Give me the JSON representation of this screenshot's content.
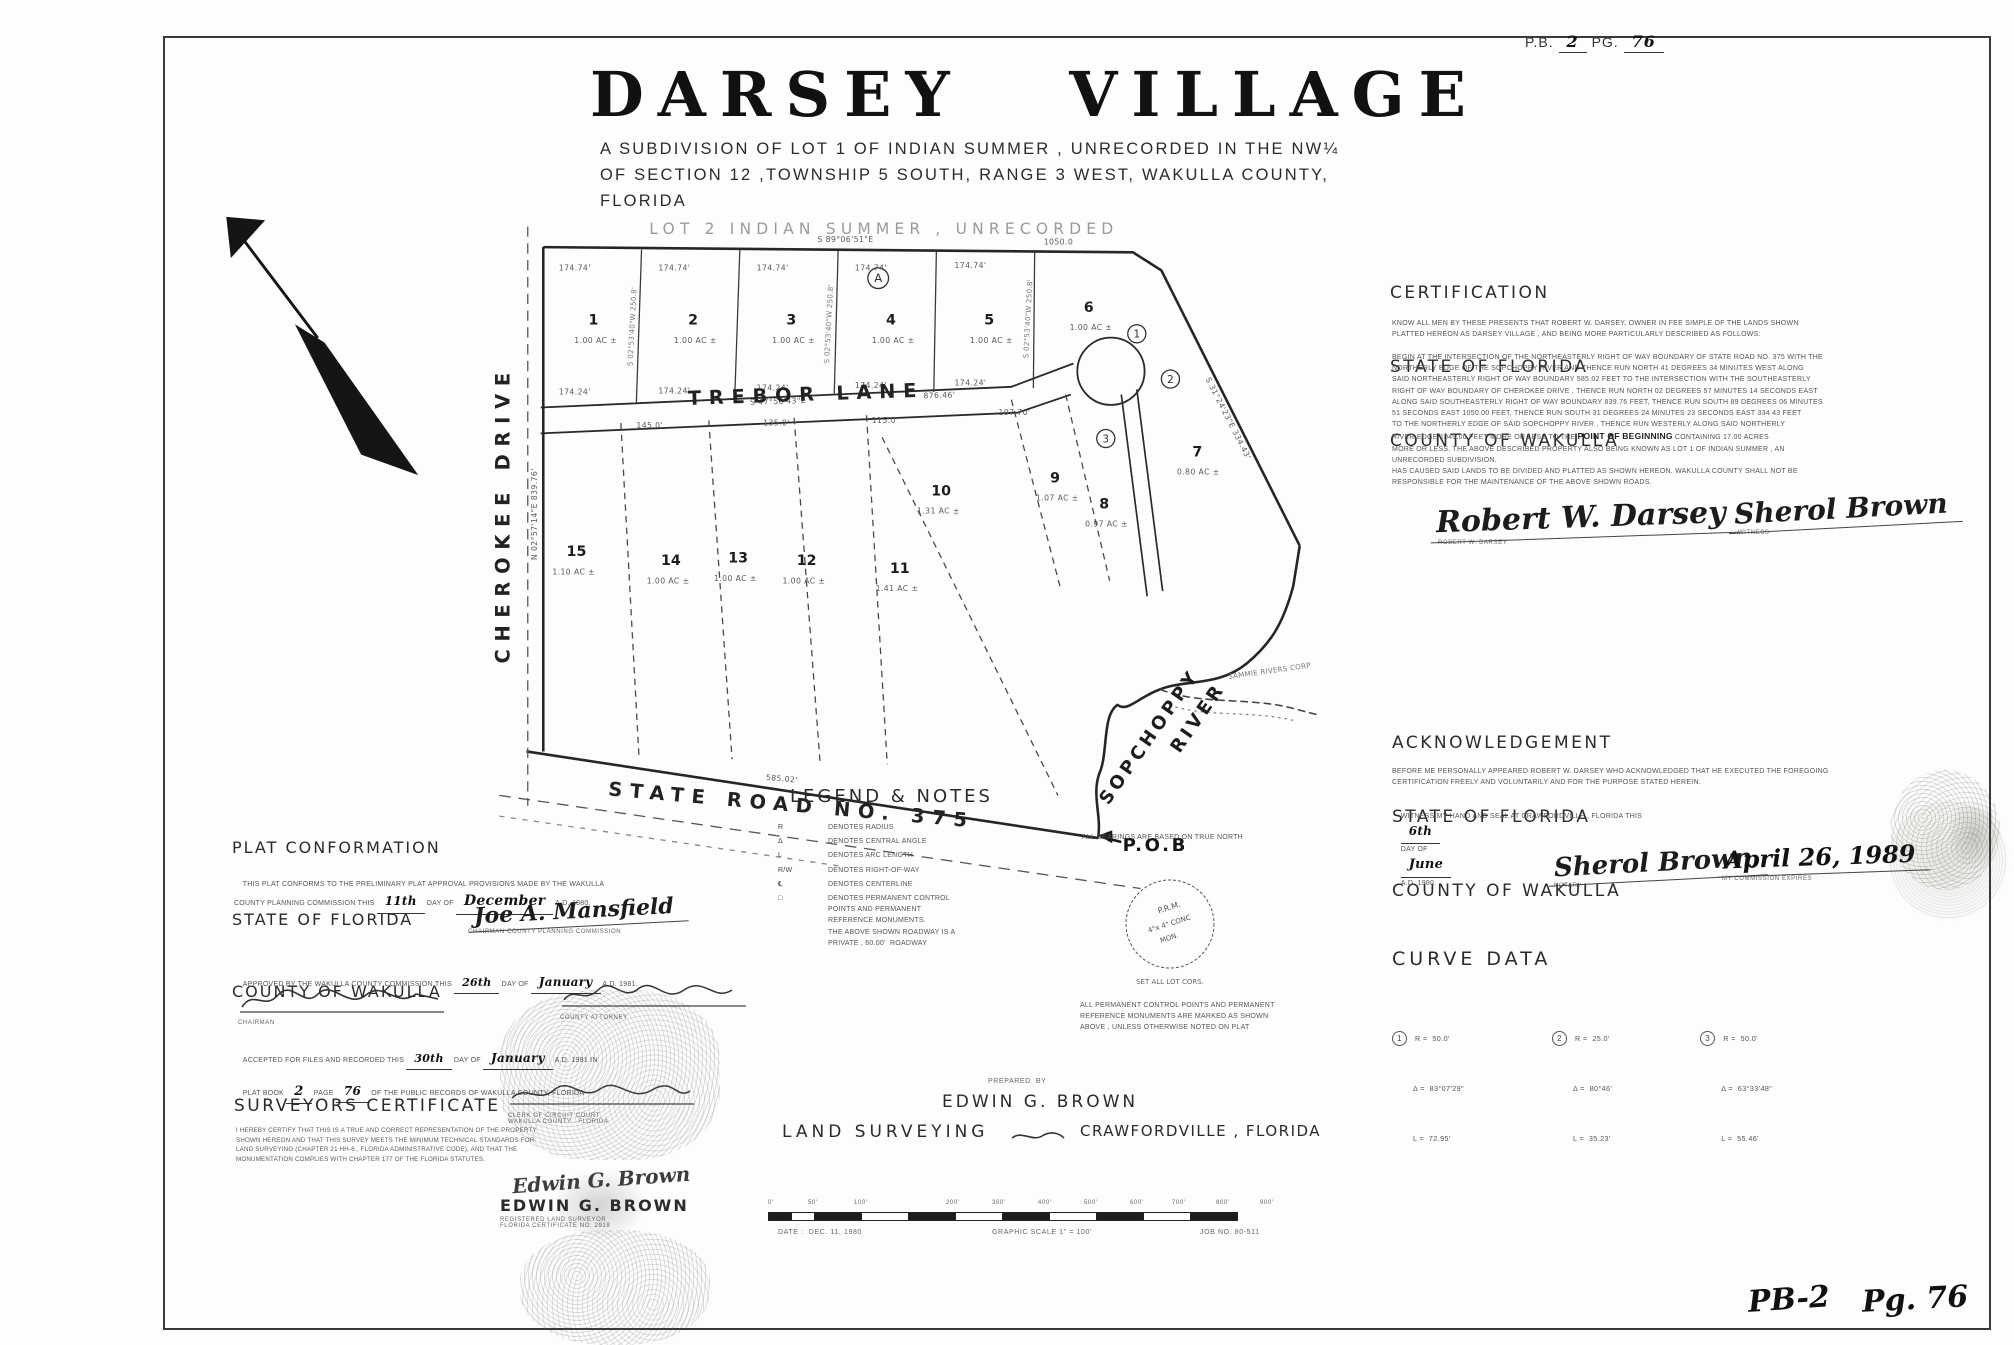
{
  "page": {
    "pb_label": "P.B.",
    "pb_value": "2",
    "pg_label": "PG.",
    "pg_value": "76",
    "corner_book": "PB-2",
    "corner_page": "Pg. 76"
  },
  "title": {
    "main": "DARSEY VILLAGE",
    "sub1": "A SUBDIVISION OF LOT 1 OF INDIAN SUMMER , UNRECORDED IN THE NW¼",
    "sub2": "OF SECTION 12 ,TOWNSHIP 5 SOUTH, RANGE 3 WEST, WAKULLA COUNTY,",
    "sub3": "FLORIDA"
  },
  "plat": {
    "faint_label": "LOT 2  INDIAN  SUMMER , UNRECORDED",
    "bearing_top": "S 89°06'51\"E",
    "dist_top": "1050.0",
    "dim_top": "174.74'",
    "dim_mid": "174.24'",
    "bearing_side": "S 02°53'40\"W  250.8'",
    "lane_bearing": "S 47°56'43\"E",
    "lane_dist": "876.46'",
    "bearing_ne": "S 31°24'23\"E  334.43'",
    "bearing_left": "N 02°57'14\"E  839.76'",
    "bearing_road": "585.02'",
    "street_trebor": "TREBOR      LANE",
    "street_cherokee": "CHEROKEE    DRIVE",
    "street_road": "STATE  ROAD  NO. 375",
    "river1": "SOPCHOPPY",
    "river2": "RIVER",
    "pob": "P.O.B",
    "corp": "SAMMIE RIVERS CORP",
    "block_mark": "A",
    "curve_marks": [
      "1",
      "2",
      "3"
    ],
    "lower_dims": [
      "145.0'",
      "135.0'",
      "115.0'",
      "107.70'"
    ],
    "lots": [
      {
        "num": "1",
        "ac": "1.00 AC ±"
      },
      {
        "num": "2",
        "ac": "1.00 AC ±"
      },
      {
        "num": "3",
        "ac": "1.00 AC ±"
      },
      {
        "num": "4",
        "ac": "1.00 AC ±"
      },
      {
        "num": "5",
        "ac": "1.00 AC ±"
      },
      {
        "num": "6",
        "ac": "1.00 AC ±"
      },
      {
        "num": "7",
        "ac": "0.80 AC ±"
      },
      {
        "num": "8",
        "ac": "0.97 AC ±"
      },
      {
        "num": "9",
        "ac": "1.07 AC ±"
      },
      {
        "num": "10",
        "ac": "1.31 AC ±"
      },
      {
        "num": "11",
        "ac": "1.41 AC ±"
      },
      {
        "num": "12",
        "ac": "1.00 AC ±"
      },
      {
        "num": "13",
        "ac": "1.00 AC ±"
      },
      {
        "num": "14",
        "ac": "1.00 AC ±"
      },
      {
        "num": "15",
        "ac": "1.10 AC ±"
      }
    ]
  },
  "certification": {
    "h1": "CERTIFICATION",
    "h2": "STATE OF FLORIDA",
    "h3": "COUNTY OF WAKULLA",
    "intro": "KNOW ALL MEN BY THESE PRESENTS THAT ROBERT W. DARSEY, OWNER IN FEE SIMPLE OF THE LANDS SHOWN\nPLATTED HEREON AS DARSEY VILLAGE , AND BEING MORE PARTICULARLY DESCRIBED AS FOLLOWS:",
    "body_pre": "BEGIN AT THE INTERSECTION OF THE NORTHEASTERLY RIGHT OF WAY BOUNDARY OF STATE ROAD NO. 375 WITH THE\nNORTHERLY EDGE OF THE SOPCHOPPY RIVER AND THENCE RUN NORTH 41 DEGREES 34 MINUTES WEST ALONG\nSAID NORTHEASTERLY RIGHT OF WAY BOUNDARY 585.02 FEET TO THE INTERSECTION WITH THE SOUTHEASTERLY\nRIGHT OF WAY BOUNDARY OF CHEROKEE DRIVE , THENCE RUN NORTH 02 DEGREES 57 MINUTES 14 SECONDS EAST\nALONG SAID SOUTHEASTERLY RIGHT OF WAY BOUNDARY 839.76 FEET, THENCE RUN SOUTH 89 DEGREES 06 MINUTES\n51 SECONDS EAST 1050.00 FEET, THENCE RUN SOUTH 31 DEGREES 24 MINUTES 23 SECONDS EAST 334.43 FEET\nTO THE NORTHERLY EDGE OF SAID SOPCHOPPY RIVER , THENCE RUN WESTERLY ALONG SAID NORTHERLY\nRIVER EDGE 1049.00 FEET MORE OR LESS TO THE ",
    "pob_bold": "POINT OF BEGINNING",
    "body_post": " CONTAINING 17.00 ACRES\nMORE OR LESS. THE ABOVE DESCRIBED PROPERTY ALSO BEING KNOWN AS LOT 1 OF INDIAN SUMMER , AN\nUNRECORDED SUBDIVISION.\nHAS CAUSED SAID LANDS TO BE DIVIDED AND PLATTED AS SHOWN HEREON. WAKULLA COUNTY SHALL NOT BE\nRESPONSIBLE FOR THE MAINTENANCE OF THE ABOVE SHOWN ROADS.",
    "sig1_script": "Robert W. Darsey",
    "sig1_label": "ROBERT W. DARSEY",
    "sig2_script": "Sherol Brown",
    "sig2_label": "WITNESS"
  },
  "acknowledgement": {
    "h1": "ACKNOWLEDGEMENT",
    "h2": "STATE OF FLORIDA",
    "h3": "COUNTY OF WAKULLA",
    "body": "BEFORE ME PERSONALLY APPEARED ROBERT W. DARSEY WHO ACKNOWLEDGED THAT HE EXECUTED THE FOREGOING\nCERTIFICATION FREELY AND VOLUNTARILY AND FOR THE PURPOSE STATED HEREIN.",
    "witness_pre": "WITNESS MY HAND AND SEAL AT CRAWFORDVILLE , FLORIDA THIS",
    "witness_day": "6th",
    "witness_mid": "DAY OF",
    "witness_month": "June",
    "witness_post": "A.D. 1980.",
    "notary_script": "Sherol Brown",
    "notary_label": "NOTARY",
    "expires_script": "April 26, 1989",
    "expires_label": "MY COMMISSION EXPIRES"
  },
  "curve_data": {
    "heading": "CURVE DATA",
    "curves": [
      {
        "n": "1",
        "r": "R =  50.0'",
        "d": "Δ =  83°07'29\"",
        "l": "L =  72.95'"
      },
      {
        "n": "2",
        "r": "R =  25.0'",
        "d": "Δ =  80°46'",
        "l": "L =  35.23'"
      },
      {
        "n": "3",
        "r": "R =  50.0'",
        "d": "Δ =  63°33'48\"",
        "l": "L =  55.46'"
      }
    ]
  },
  "conformation": {
    "h1": "PLAT CONFORMATION",
    "h2": "STATE OF FLORIDA",
    "h3": "COUNTY OF WAKULLA",
    "body_pre": "THIS PLAT CONFORMS TO THE PRELIMINARY PLAT APPROVAL PROVISIONS MADE BY THE WAKULLA\nCOUNTY PLANNING COMMISSION THIS ",
    "day": "11th",
    "mid": " DAY OF ",
    "month": "December",
    "post": " A.D. 1980.",
    "sig_chair_script": "Joe A. Mansfield",
    "sig_chair_label": "CHAIRMAN COUNTY PLANNING COMMISSION",
    "approved_pre": "APPROVED BY THE WAKULLA COUNTY COMMISSION THIS ",
    "approved_day": "26th",
    "approved_mid": " DAY OF ",
    "approved_month": "January",
    "approved_post": " A.D. 1981.",
    "chairman_label": "CHAIRMAN",
    "attorney_label": "COUNTY ATTORNEY",
    "recorded_pre": "ACCEPTED FOR FILES AND RECORDED THIS ",
    "recorded_day": "30th",
    "recorded_mid": " DAY OF ",
    "recorded_month": "January",
    "recorded_post": " A.D. 1981 IN",
    "recorded2_pre": "PLAT BOOK ",
    "book": "2",
    "page_mid": " PAGE ",
    "page": "76",
    "recorded2_post": " OF THE PUBLIC RECORDS OF WAKULLA COUNTY, FLORIDA",
    "clerk_label": "CLERK OF CIRCUIT COURT\nWAKULLA COUNTY , FLORIDA"
  },
  "legend": {
    "heading": "LEGEND & NOTES",
    "items": [
      {
        "sym": "R",
        "text": "DENOTES RADIUS"
      },
      {
        "sym": "Δ",
        "text": "DENOTES CENTRAL ANGLE"
      },
      {
        "sym": "L",
        "text": "DENOTES ARC LENGTH"
      },
      {
        "sym": "R/W",
        "text": "DENOTES RIGHT-OF-WAY"
      },
      {
        "sym": "℄",
        "text": "DENOTES CENTERLINE"
      },
      {
        "sym": "□",
        "text": "DENOTES PERMANENT CONTROL\nPOINTS AND PERMANENT\nREFERENCE MONUMENTS.\nTHE ABOVE SHOWN ROADWAY IS A\nPRIVATE , 60.00'  ROADWAY"
      }
    ],
    "bearings_note": "ALL BEARINGS ARE BASED ON TRUE NORTH",
    "mc1": "P.R.M.",
    "mc2": "4\"x 4\" CONC",
    "mc3": "MON.",
    "mc4": "SET ALL LOT CORS.",
    "monument_note": "ALL PERMANENT CONTROL POINTS AND PERMANENT\nREFERENCE MONUMENTS ARE MARKED AS SHOWN\nABOVE , UNLESS OTHERWISE NOTED ON PLAT"
  },
  "surveyor": {
    "heading": "SURVEYORS  CERTIFICATE",
    "body": "I HEREBY CERTIFY THAT THIS IS A TRUE AND CORRECT REPRESENTATION OF THE PROPERTY\nSHOWN HEREON AND THAT THIS SURVEY MEETS THE MINIMUM TECHNICAL STANDARDS FOR\nLAND SURVEYING (CHAPTER 21 HH-6 , FLORIDA ADMINISTRATIVE CODE), AND THAT THE\nMONUMENTATION COMPLIES WITH CHAPTER 177 OF THE FLORIDA STATUTES.",
    "sig_script": "Edwin G. Brown",
    "name": "EDWIN  G. BROWN",
    "reg1": "REGISTERED LAND SURVEYOR",
    "reg2": "FLORIDA CERTIFICATE NO. 2918"
  },
  "prepared": {
    "pre": "PREPARED  BY",
    "name": "EDWIN  G. BROWN",
    "left": "LAND  SURVEYING",
    "right": "CRAWFORDVILLE , FLORIDA"
  },
  "scalebar": {
    "ticks": [
      "0'",
      "50'",
      "100'",
      "200'",
      "300'",
      "400'",
      "500'",
      "600'",
      "700'",
      "800'",
      "900'"
    ],
    "date": "DATE :  DEC. 11, 1980",
    "scale": "GRAPHIC SCALE 1\" = 100'",
    "job": "JOB NO. 80-511"
  }
}
